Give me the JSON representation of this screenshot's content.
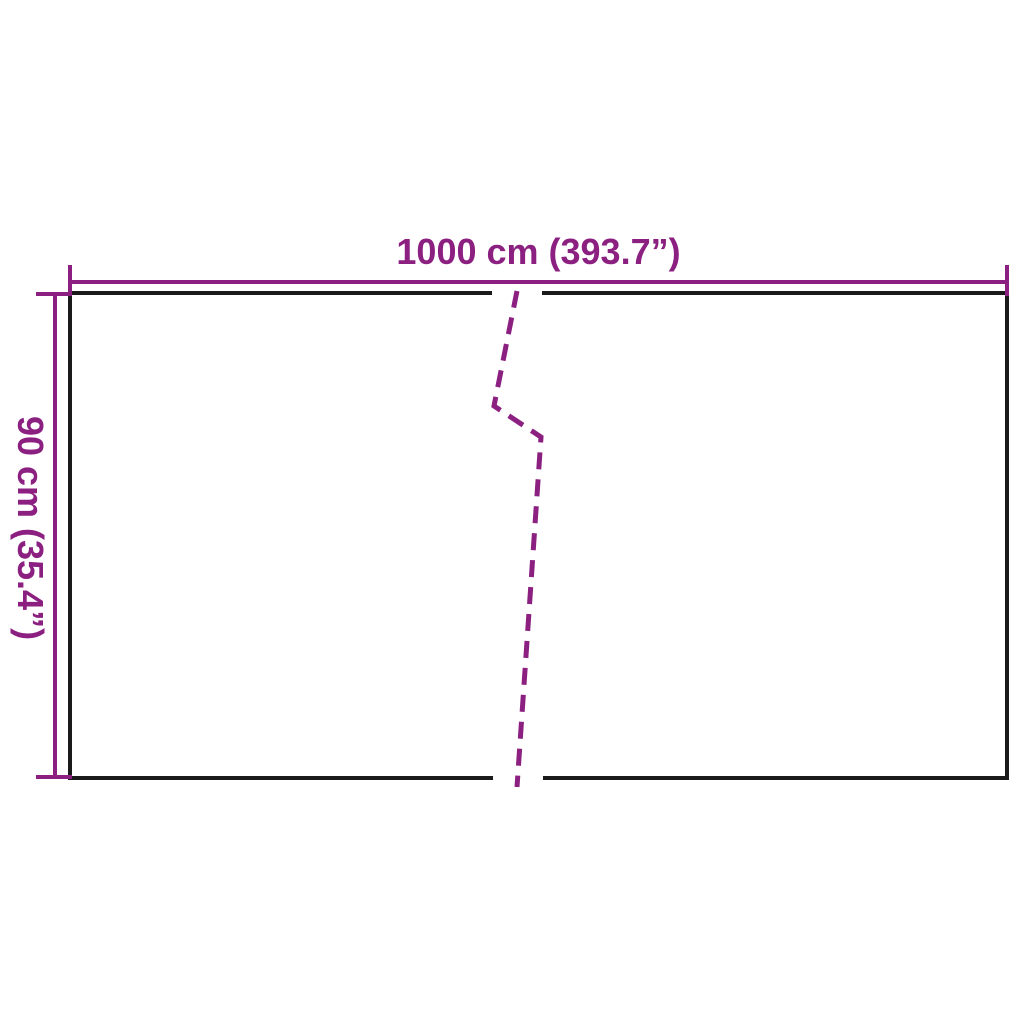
{
  "labels": {
    "width": "1000 cm (393.7”)",
    "height": "90 cm (35.4”)"
  },
  "colors": {
    "dimension": "#8B2081",
    "outline": "#1A1A1A",
    "background": "#FFFFFF"
  }
}
